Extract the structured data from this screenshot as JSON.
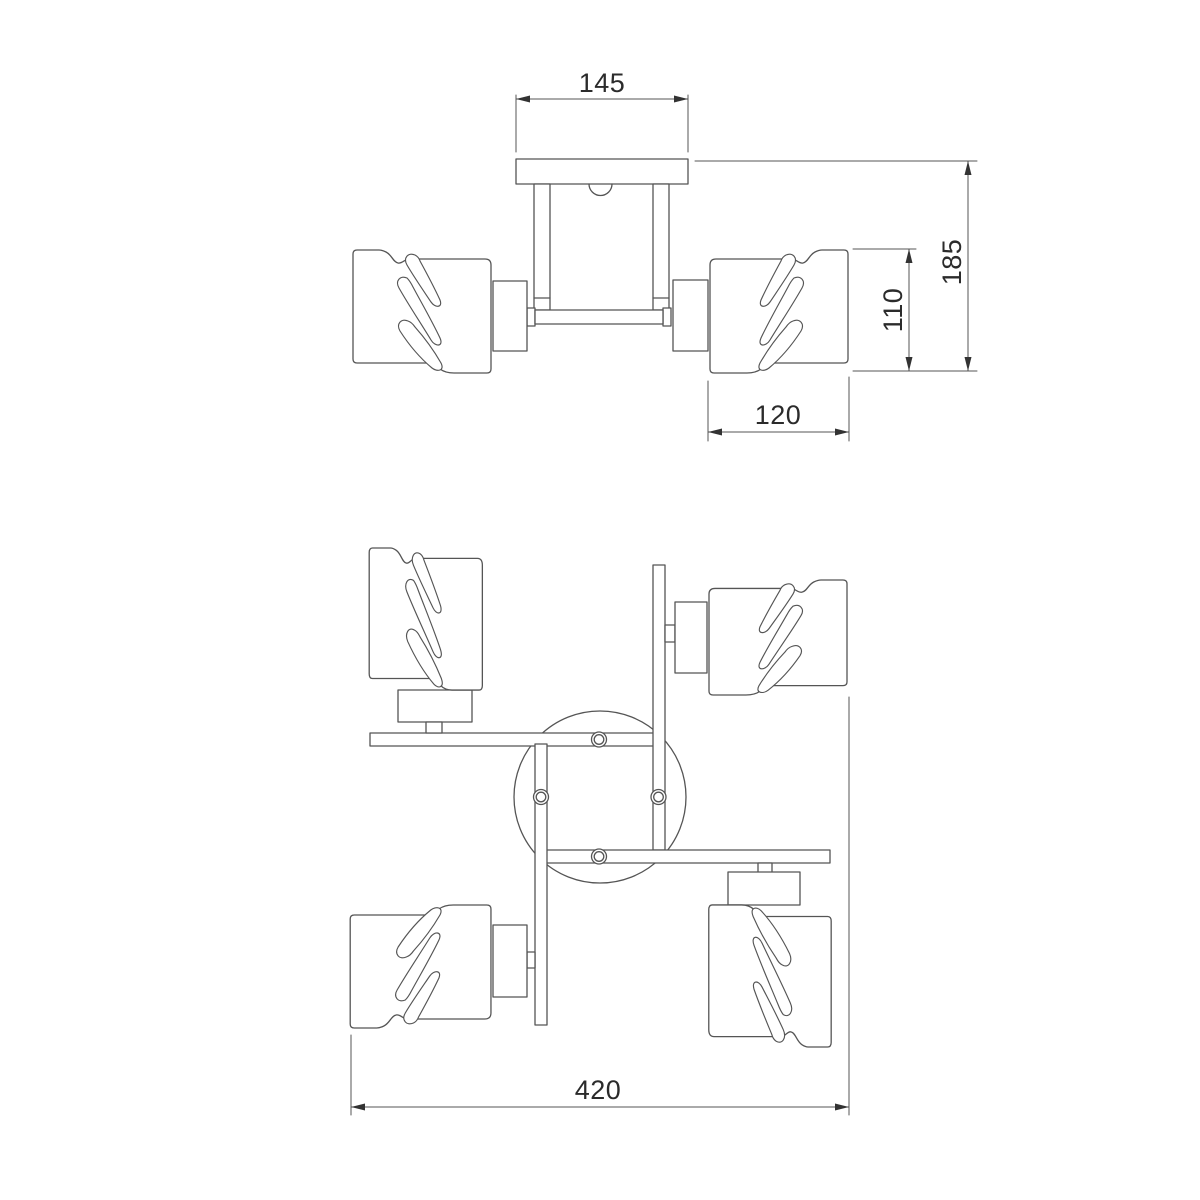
{
  "drawing": {
    "description": "ceiling-light-fixture-dimension-drawing",
    "views": [
      "front-view",
      "plan-view"
    ],
    "colors": {
      "background": "#ffffff",
      "line": "#555555",
      "dimension_text": "#2b2b2b",
      "arrow": "#333333"
    }
  },
  "dimensions": {
    "plate_width": "145",
    "total_height": "185",
    "shade_height": "110",
    "shade_width": "120",
    "total_width": "420"
  }
}
